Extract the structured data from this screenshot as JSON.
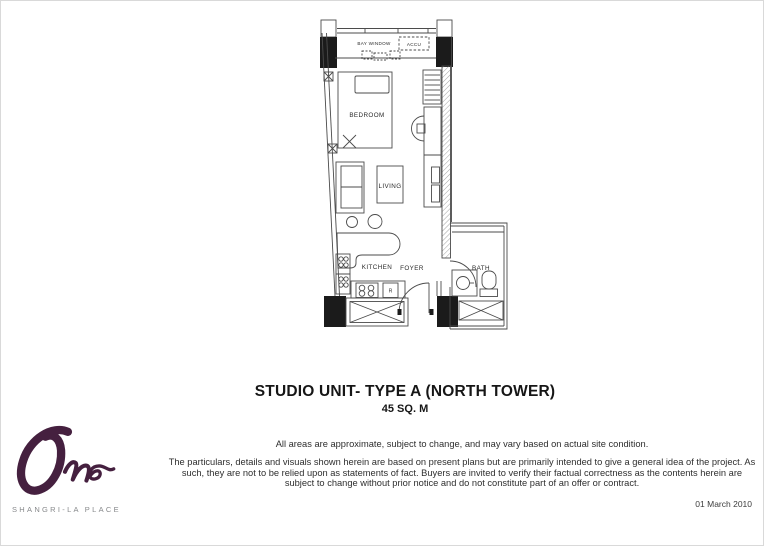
{
  "title": {
    "main": "STUDIO UNIT- TYPE A (NORTH TOWER)",
    "area": "45 SQ. M"
  },
  "disclaimer": {
    "line1": "All areas are approximate, subject to change, and may vary based on actual site condition.",
    "para2": "The particulars, details and visuals shown herein are based on present plans but are primarily intended to give a general idea of the project. As such, they are not to be relied upon as statements of fact. Buyers are invited to verify their factual correctness as the contents herein are subject to change without prior notice and do not constitute part of an offer or contract."
  },
  "footer": {
    "date": "01 March 2010"
  },
  "logo": {
    "wordmark": "One",
    "subtitle": "SHANGRI-LA PLACE",
    "brand_color": "#45203f",
    "subtitle_color": "#87898b"
  },
  "floorplan": {
    "labels": {
      "bay_window": "BAY WINDOW",
      "accu": "ACCU",
      "bedroom": "BEDROOM",
      "living": "LIVING",
      "kitchen": "KITCHEN",
      "foyer": "FOYER",
      "bath": "BATH",
      "refrigerator": "R"
    }
  }
}
